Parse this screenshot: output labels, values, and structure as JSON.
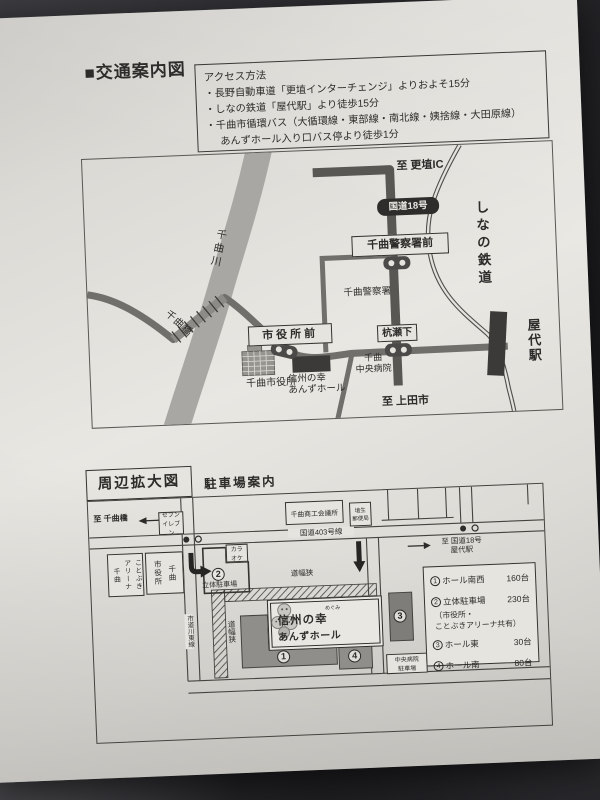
{
  "colors": {
    "paper": "#e6e4df",
    "ink": "#2d2c2a",
    "road_gray": "#6e6c68",
    "river_gray": "#a7a5a1",
    "building_dark": "#3b3a38",
    "parking_gray": "#908e8a"
  },
  "header": {
    "title": "■交通案内図"
  },
  "access": {
    "title": "アクセス方法",
    "items": [
      "・長野自動車道「更埴インターチェンジ」よりおよそ15分",
      "・しなの鉄道「屋代駅」より徒歩15分",
      "・千曲市循環バス（大循環線・東部線・南北線・姨捨線・大田原線）",
      "あんずホール入り口バス停より徒歩1分"
    ]
  },
  "map1": {
    "to_koshoku_ic": "至 更埴IC",
    "route18_badge": "国道18号",
    "police_front_stop": "千曲警察署前",
    "police_station": "千曲警察署",
    "shinano_railway": "しなの鉄道",
    "yashiro_station": "屋代駅",
    "kuisegake_stop": "杭瀬下",
    "central_hospital": "千曲\n中央病院",
    "to_ueda": "至 上田市",
    "city_hall_stop": "市役所前",
    "city_hall": "千曲市役所",
    "anzu_hall": "信州の幸\nあんずホール",
    "chikuma_river": "千曲川",
    "chikuma_bridge": "千曲橋"
  },
  "map2": {
    "section_title": "周辺拡大図",
    "section_subtitle": "駐車場案内",
    "seven_eleven": "セブン\nイレブン",
    "to_chikuma_bridge": "至 千曲橋",
    "chamber_of_commerce": "千曲商工会議所",
    "post_office": "埴生\n郵便局",
    "route403": "国道403号線",
    "to_route18": "至 国道18号\n屋代駅",
    "kotobuki_arena": "ことぶき\nアリーナ\n千曲",
    "city_hall": "千曲\n市役所",
    "karaoke": "カラ\nオケ",
    "parking_structure": "立体駐車場",
    "narrow_road_top": "道幅狭",
    "narrow_road_side": "道幅狭",
    "city_road": "市道川東線",
    "hall_logo_line1": "信州の幸",
    "hall_logo_furigana": "めぐみ",
    "hall_logo_line2": "あんずホール",
    "hospital_parking": "中央病院\n駐車場",
    "marks": {
      "p1": "1",
      "p2": "2",
      "p3": "3",
      "p4": "4"
    }
  },
  "legend": {
    "items": [
      {
        "num": "1",
        "name": "ホール南西",
        "count": "160台",
        "note": ""
      },
      {
        "num": "2",
        "name": "立体駐車場",
        "count": "230台",
        "note": "（市役所・\nことぶきアリーナ共有）"
      },
      {
        "num": "3",
        "name": "ホール東",
        "count": "30台",
        "note": ""
      },
      {
        "num": "4",
        "name": "ホール南",
        "count": "80台",
        "note": ""
      }
    ]
  }
}
